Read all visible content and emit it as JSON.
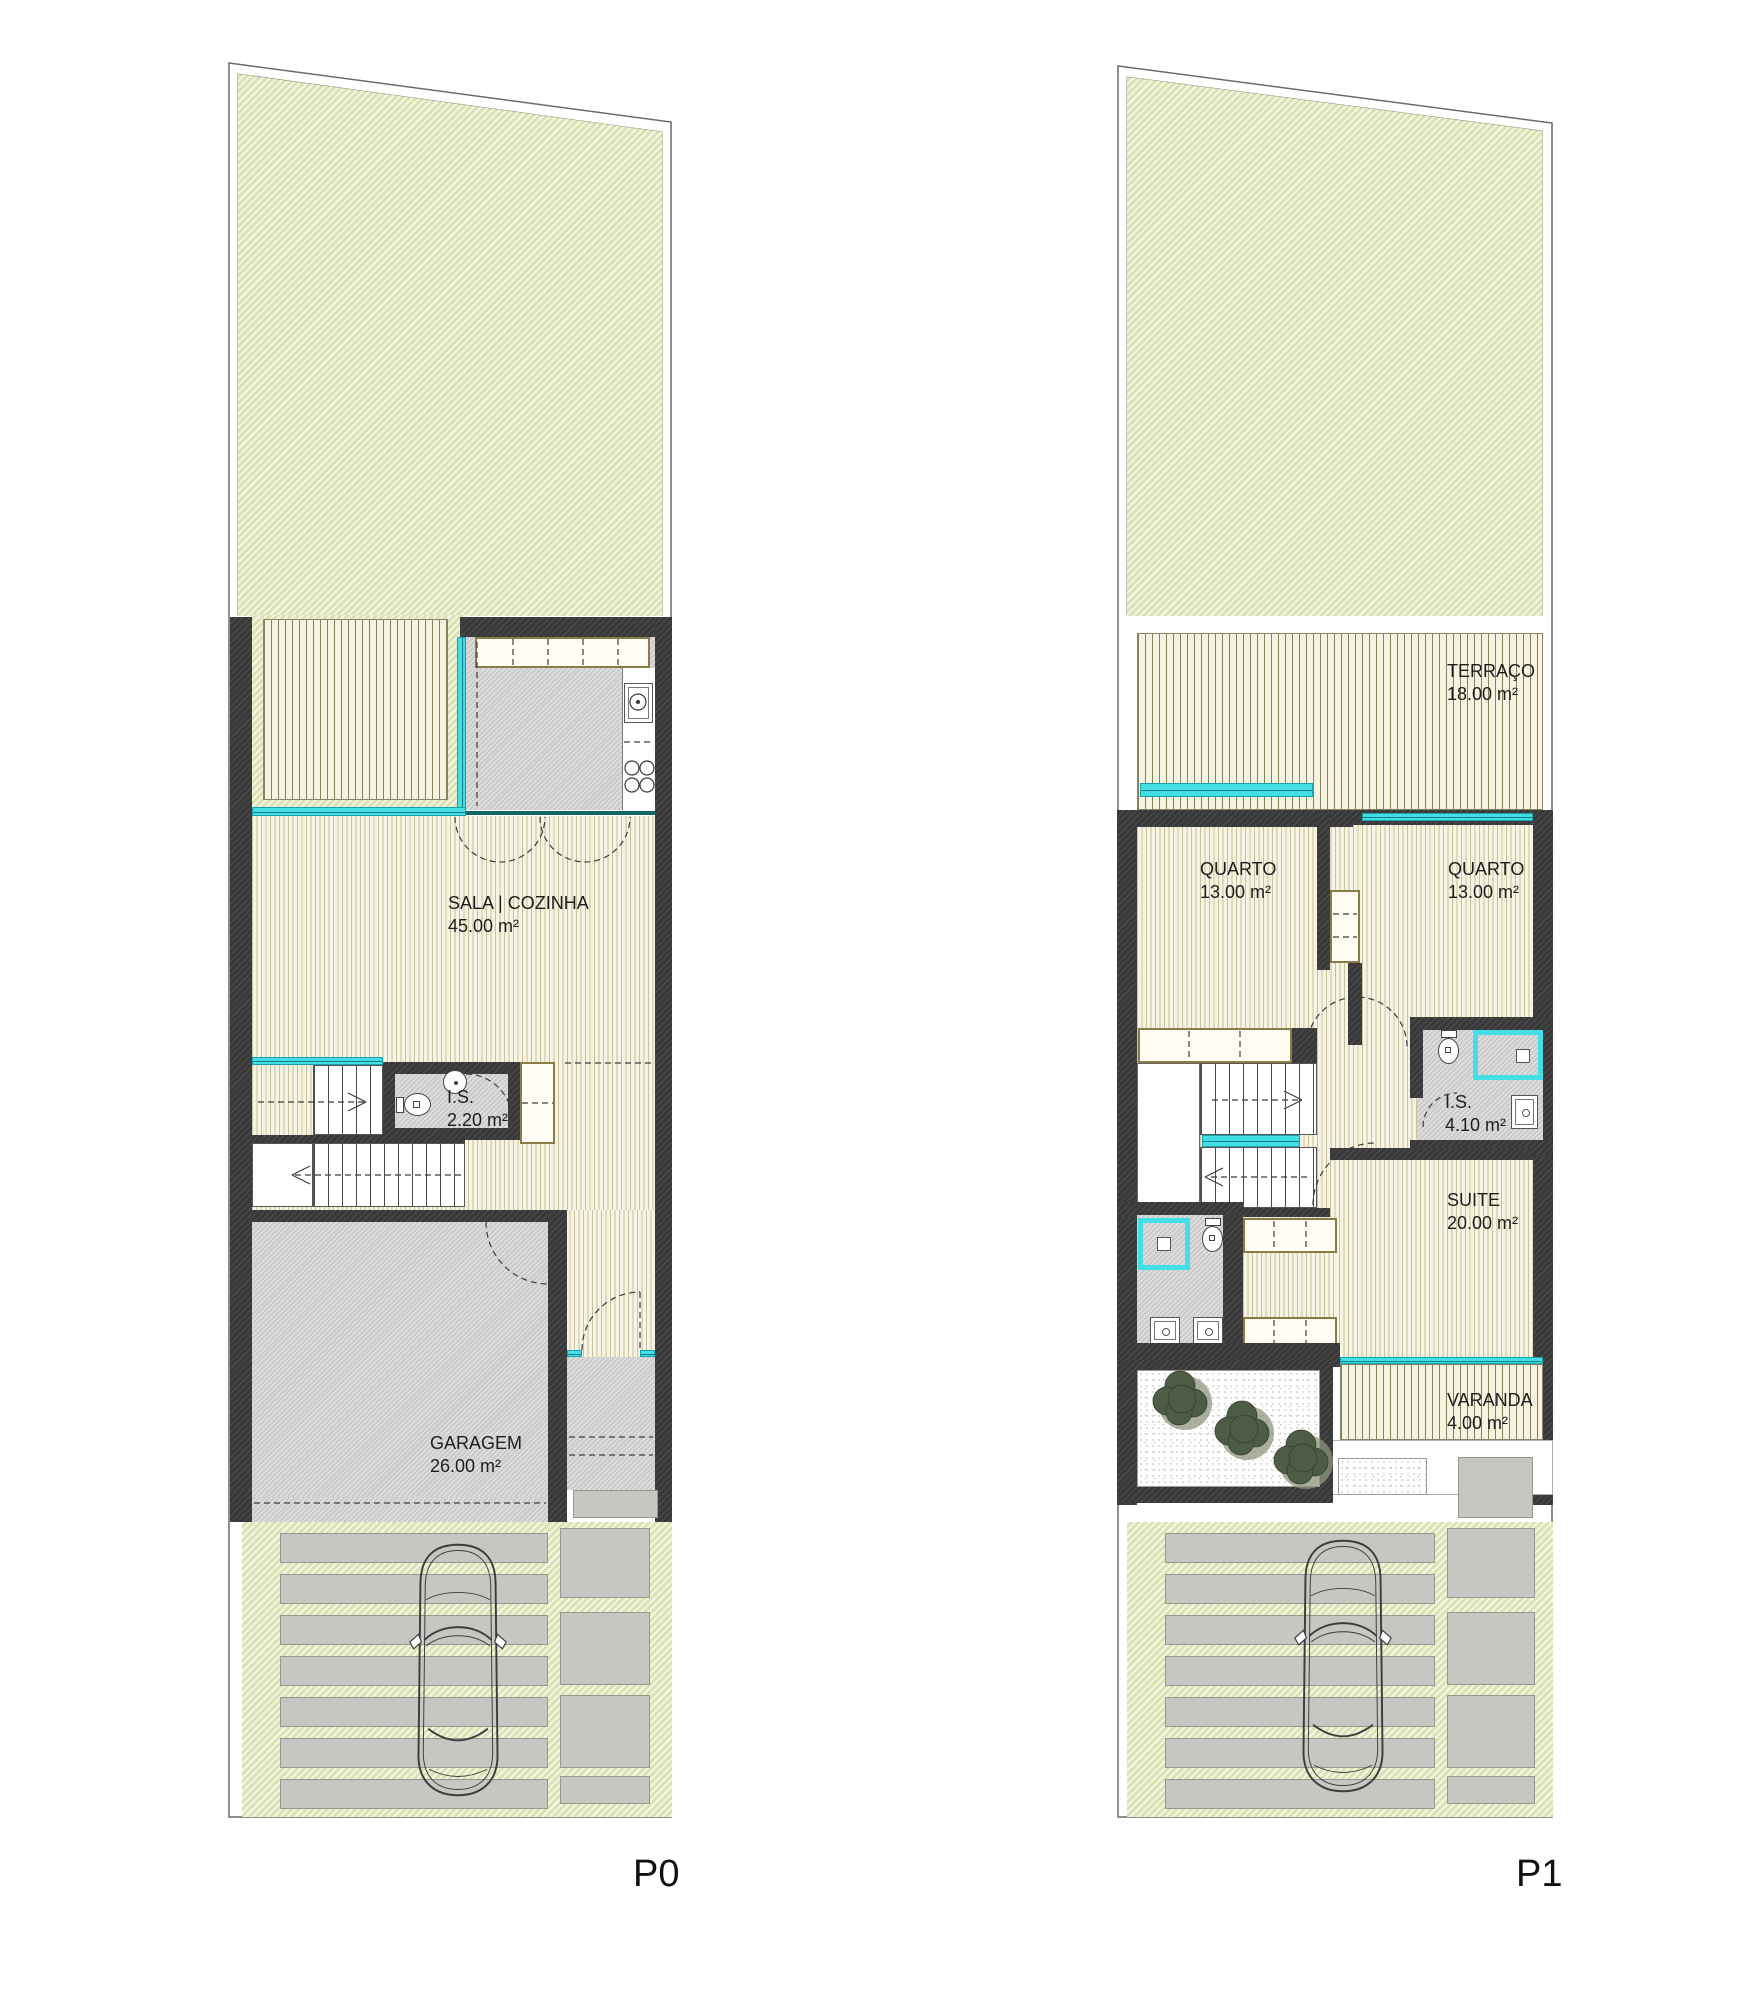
{
  "document": {
    "type": "architectural floor plans, two levels of a townhouse"
  },
  "plans": [
    {
      "label": "P0",
      "rooms": {
        "sala": {
          "name": "SALA | COZINHA",
          "area": "45.00 m²"
        },
        "is": {
          "name": "I.S.",
          "area": "2.20 m²"
        },
        "garagem": {
          "name": "GARAGEM",
          "area": "26.00 m²"
        }
      }
    },
    {
      "label": "P1",
      "rooms": {
        "terraco": {
          "name": "TERRAÇO",
          "area": "18.00 m²"
        },
        "quarto_esq": {
          "name": "QUARTO",
          "area": "13.00 m²"
        },
        "quarto_dir": {
          "name": "QUARTO",
          "area": "13.00 m²"
        },
        "is": {
          "name": "I.S.",
          "area": "4.10 m²"
        },
        "suite": {
          "name": "SUITE",
          "area": "20.00 m²"
        },
        "varanda": {
          "name": "VARANDA",
          "area": "4.00 m²"
        }
      }
    }
  ],
  "colors": {
    "garden": "#dce2b3",
    "deck_line": "#85815f",
    "wood_line": "#c9c29e",
    "wall": "#383838",
    "floor_gray": "#cbcbcb",
    "glazing_cyan": "#44dfe6",
    "teal_frame": "#11666c",
    "slab_gray": "#c5c7c2",
    "tree_green": "#4d5c44",
    "label_text": "#1d1d1d"
  }
}
